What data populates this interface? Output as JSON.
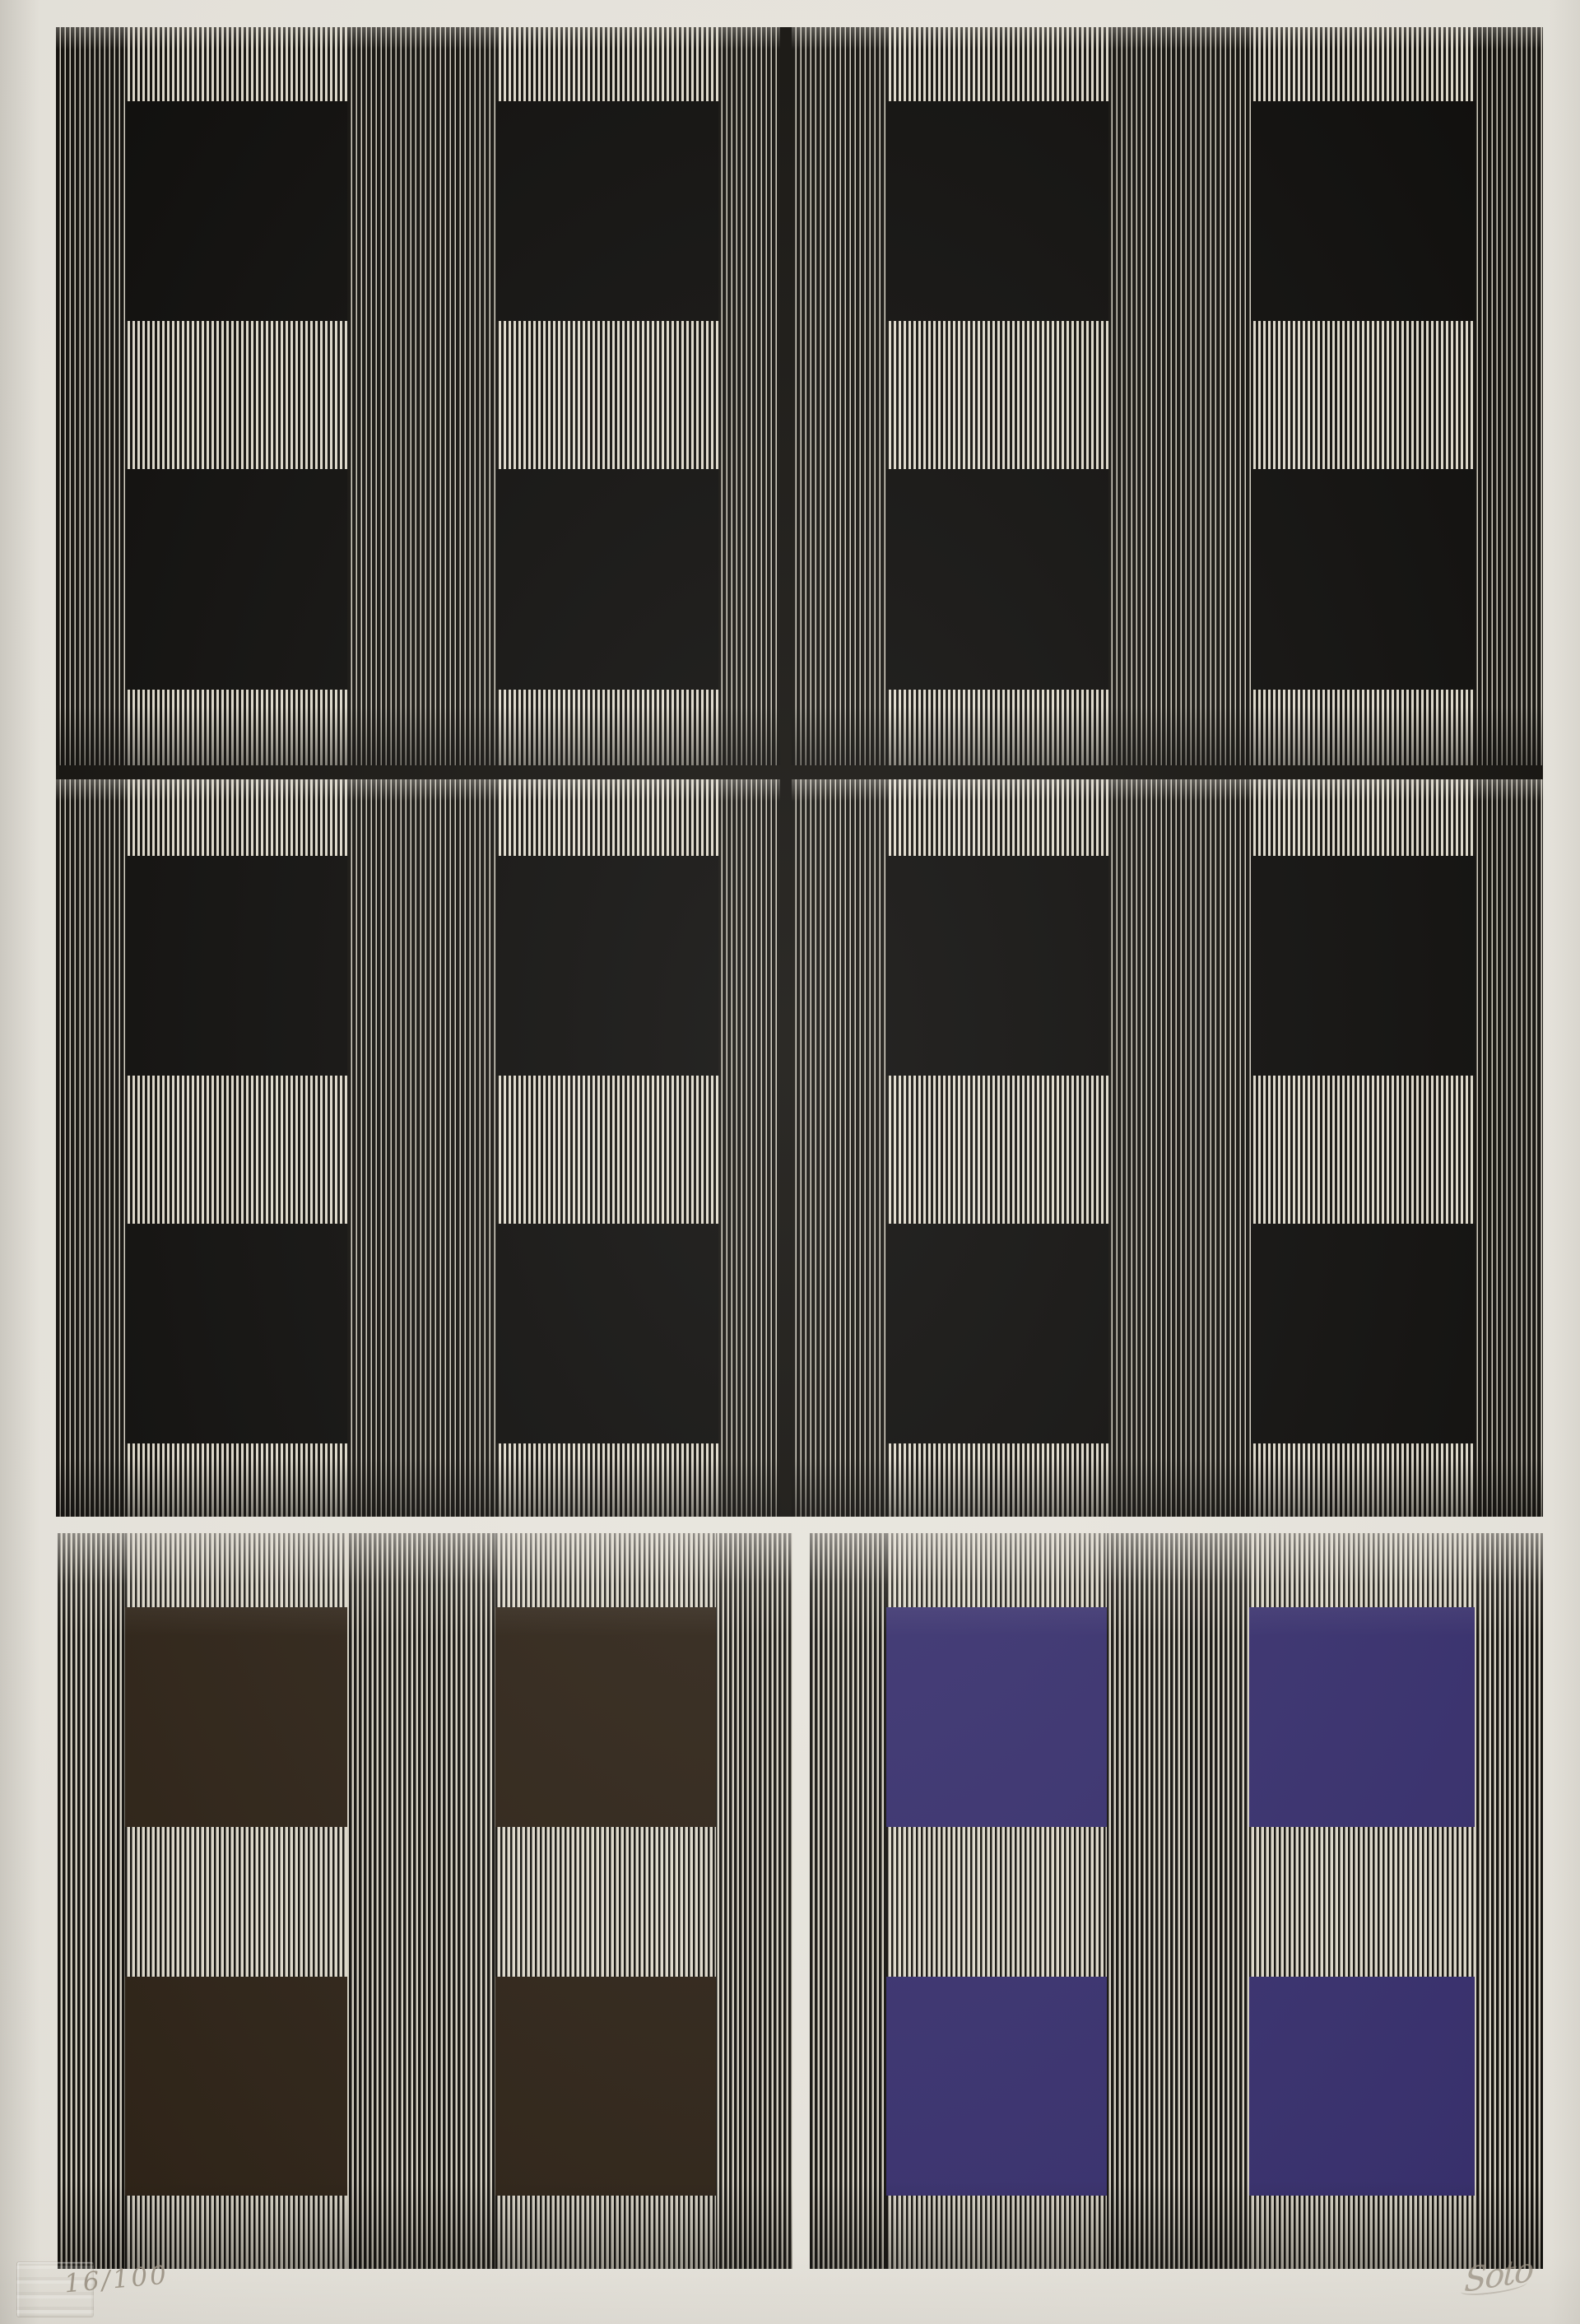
{
  "artwork": {
    "edition_number": "16/100",
    "signature": "Soto"
  },
  "palette": {
    "paper": "#e9e6de",
    "ink_black": "#14120e",
    "stripe_cream": "#d8d3c5",
    "stripe_highlight": "#e0dbcd",
    "square_black": "#0e0d0b",
    "square_brown": "#2e2317",
    "square_purple": "#38306e",
    "pencil_gray": "#9a9183"
  },
  "panels": {
    "top_square_color_name": "black",
    "bottom_left_square_color_name": "dark brown",
    "bottom_right_square_color_name": "dark violet"
  }
}
